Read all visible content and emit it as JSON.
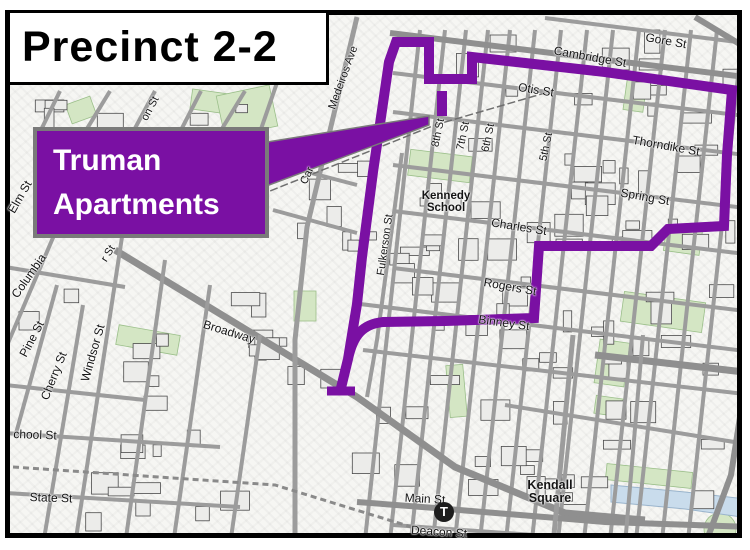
{
  "title": "Precinct 2-2",
  "callout": {
    "line1": "Truman",
    "line2": "Apartments"
  },
  "colors": {
    "boundary_purple": "#7A10A3",
    "callout_fill": "#7A10A3",
    "street_gray": "#9c9c9c",
    "major_street_gray": "#8f8f8f",
    "park_green": "#d4e6c4",
    "water_blue": "#c9dcec",
    "label_black": "#141414"
  },
  "transit": {
    "station_letter": "T"
  },
  "landmarks": [
    {
      "name": "kennedy-school-label",
      "lines": "Kennedy\nSchool",
      "x": 441,
      "y": 197,
      "size": 11.5
    },
    {
      "name": "kendall-square-label",
      "lines": "Kendall\nSquare",
      "x": 545,
      "y": 487,
      "size": 12.5
    }
  ],
  "street_labels": [
    {
      "name": "gore-st-label",
      "text": "Gore St",
      "x": 661,
      "y": 36,
      "rot": 10,
      "size": 12
    },
    {
      "name": "cambridge-st-label",
      "text": "Cambridge St",
      "x": 585,
      "y": 52,
      "rot": 10,
      "size": 12
    },
    {
      "name": "otis-st-label",
      "text": "Otis St",
      "x": 531,
      "y": 85,
      "rot": 9,
      "size": 12
    },
    {
      "name": "thorndike-st-label",
      "text": "Thorndike St",
      "x": 661,
      "y": 141,
      "rot": 10,
      "size": 12
    },
    {
      "name": "spring-st-label",
      "text": "Spring St",
      "x": 640,
      "y": 192,
      "rot": 10,
      "size": 12
    },
    {
      "name": "charles-st-label",
      "text": "Charles St",
      "x": 514,
      "y": 222,
      "rot": 9,
      "size": 12
    },
    {
      "name": "rogers-st-label",
      "text": "Rogers St",
      "x": 505,
      "y": 282,
      "rot": 10,
      "size": 12
    },
    {
      "name": "binney-st-label",
      "text": "Binney St",
      "x": 499,
      "y": 318,
      "rot": 8,
      "size": 12
    },
    {
      "name": "eighth-st-label",
      "text": "8th St",
      "x": 434,
      "y": 128,
      "rot": -78,
      "size": 11
    },
    {
      "name": "seventh-st-label",
      "text": "7th St",
      "x": 459,
      "y": 131,
      "rot": -78,
      "size": 11
    },
    {
      "name": "sixth-st-label",
      "text": "6th St",
      "x": 484,
      "y": 133,
      "rot": -78,
      "size": 11
    },
    {
      "name": "fifth-st-label",
      "text": "5th St",
      "x": 542,
      "y": 142,
      "rot": -78,
      "size": 11
    },
    {
      "name": "medeiros-ave-label",
      "text": "Medeiros Ave",
      "x": 339,
      "y": 73,
      "rot": -70,
      "size": 11
    },
    {
      "name": "cardinal-ave-fragment",
      "text": "Car",
      "x": 303,
      "y": 171,
      "rot": -65,
      "size": 11
    },
    {
      "name": "fulkerson-st-label",
      "text": "Fulkerson St",
      "x": 381,
      "y": 240,
      "rot": -82,
      "size": 11
    },
    {
      "name": "main-st-label",
      "text": "Main St",
      "x": 420,
      "y": 494,
      "rot": 3,
      "size": 12
    },
    {
      "name": "deacon-st-label",
      "text": "Deacon St",
      "x": 434,
      "y": 527,
      "rot": 4,
      "size": 12
    },
    {
      "name": "broadway-label",
      "text": "Broadway",
      "x": 224,
      "y": 327,
      "rot": 17,
      "size": 12
    },
    {
      "name": "columbia-label",
      "text": "Columbia",
      "x": 24,
      "y": 271,
      "rot": -55,
      "size": 12
    },
    {
      "name": "pine-st-label",
      "text": "Pine St",
      "x": 27,
      "y": 334,
      "rot": -62,
      "size": 12
    },
    {
      "name": "cherry-st-label",
      "text": "Cherry St",
      "x": 49,
      "y": 371,
      "rot": -68,
      "size": 12
    },
    {
      "name": "windsor-st-label",
      "text": "Windsor St",
      "x": 88,
      "y": 348,
      "rot": -74,
      "size": 12
    },
    {
      "name": "school-st-label",
      "text": "chool St",
      "x": 30,
      "y": 430,
      "rot": 2,
      "size": 12
    },
    {
      "name": "state-st-label",
      "text": "State St",
      "x": 46,
      "y": 493,
      "rot": 2,
      "size": 12
    },
    {
      "name": "elm-st-label",
      "text": "Elm St",
      "x": 15,
      "y": 192,
      "rot": -60,
      "size": 12
    },
    {
      "name": "on-st-fragment",
      "text": "on St",
      "x": 146,
      "y": 104,
      "rot": -62,
      "size": 11
    },
    {
      "name": "r-st-fragment",
      "text": "r St",
      "x": 104,
      "y": 249,
      "rot": -58,
      "size": 11
    }
  ]
}
